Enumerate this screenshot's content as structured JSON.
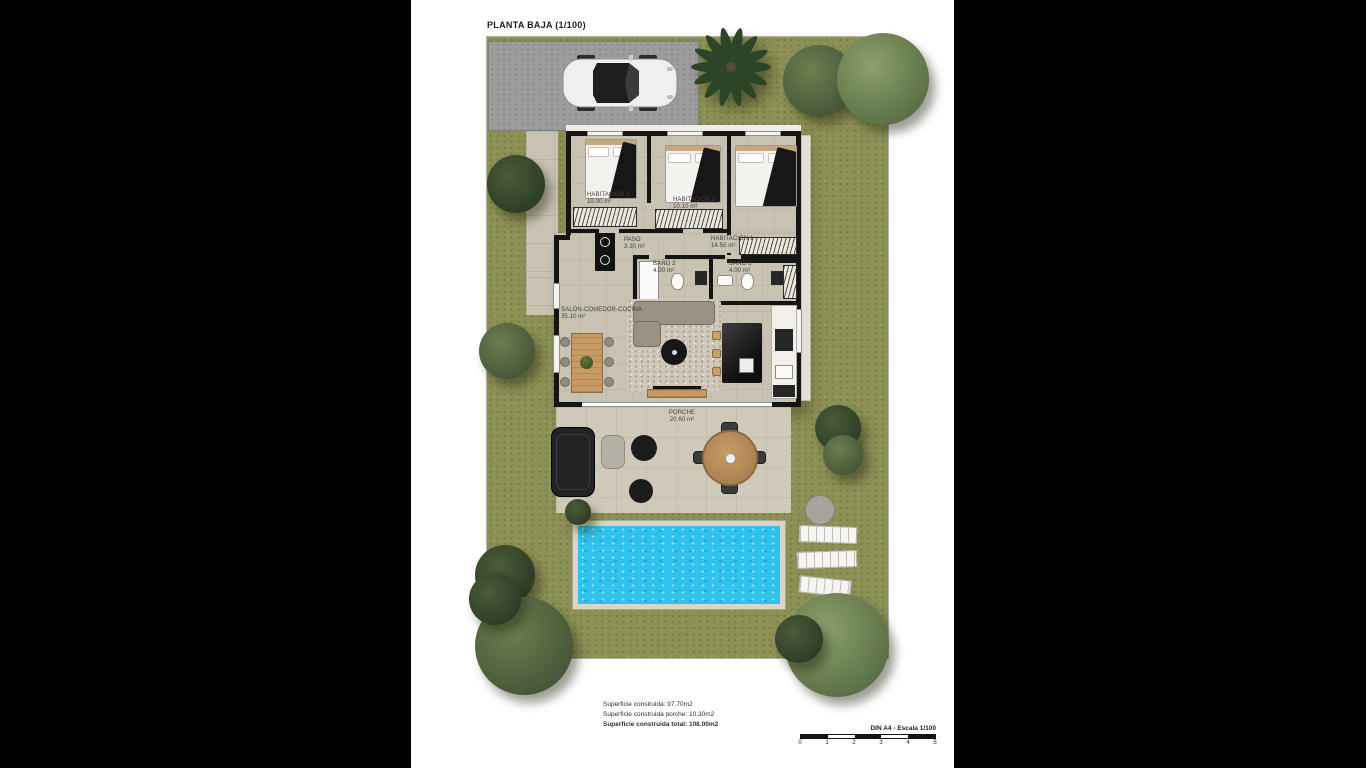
{
  "page": {
    "title": "PLANTA BAJA (1/100)"
  },
  "rooms": [
    {
      "id": "habitacion-3",
      "label": "HABITACIÓN 3",
      "area": "10.00 m²"
    },
    {
      "id": "habitacion-2",
      "label": "HABITACIÓN 2",
      "area": "10.10 m²"
    },
    {
      "id": "habitacion-1",
      "label": "HABITACIÓN 1",
      "area": "14.50 m²"
    },
    {
      "id": "paso",
      "label": "PASO",
      "area": "3.30 m²"
    },
    {
      "id": "bano-2",
      "label": "BAÑO 2",
      "area": "4.00 m²"
    },
    {
      "id": "bano-1",
      "label": "BAÑO 1",
      "area": "4.00 m²"
    },
    {
      "id": "salon",
      "label": "SALÓN-COMEDOR-COCINA",
      "area": "35.10 m²"
    },
    {
      "id": "porche",
      "label": "PORCHE",
      "area": "20.60 m²"
    }
  ],
  "summary": {
    "line1": "Superficie construida: 97.70m2",
    "line2": "Superficie construida porche: 10.30m2",
    "line3": "Superficie construida total: 108.00m2"
  },
  "scalebar": {
    "label": "DIN A4 - Escala 1/100",
    "ticks": [
      "0",
      "1",
      "2",
      "3",
      "4",
      "5"
    ]
  },
  "colors": {
    "grass": "#8c9054",
    "pool_water": "#2ec2ec",
    "driveway": "#9d9d9d",
    "wall": "#151515",
    "wood": "#c69a62"
  }
}
